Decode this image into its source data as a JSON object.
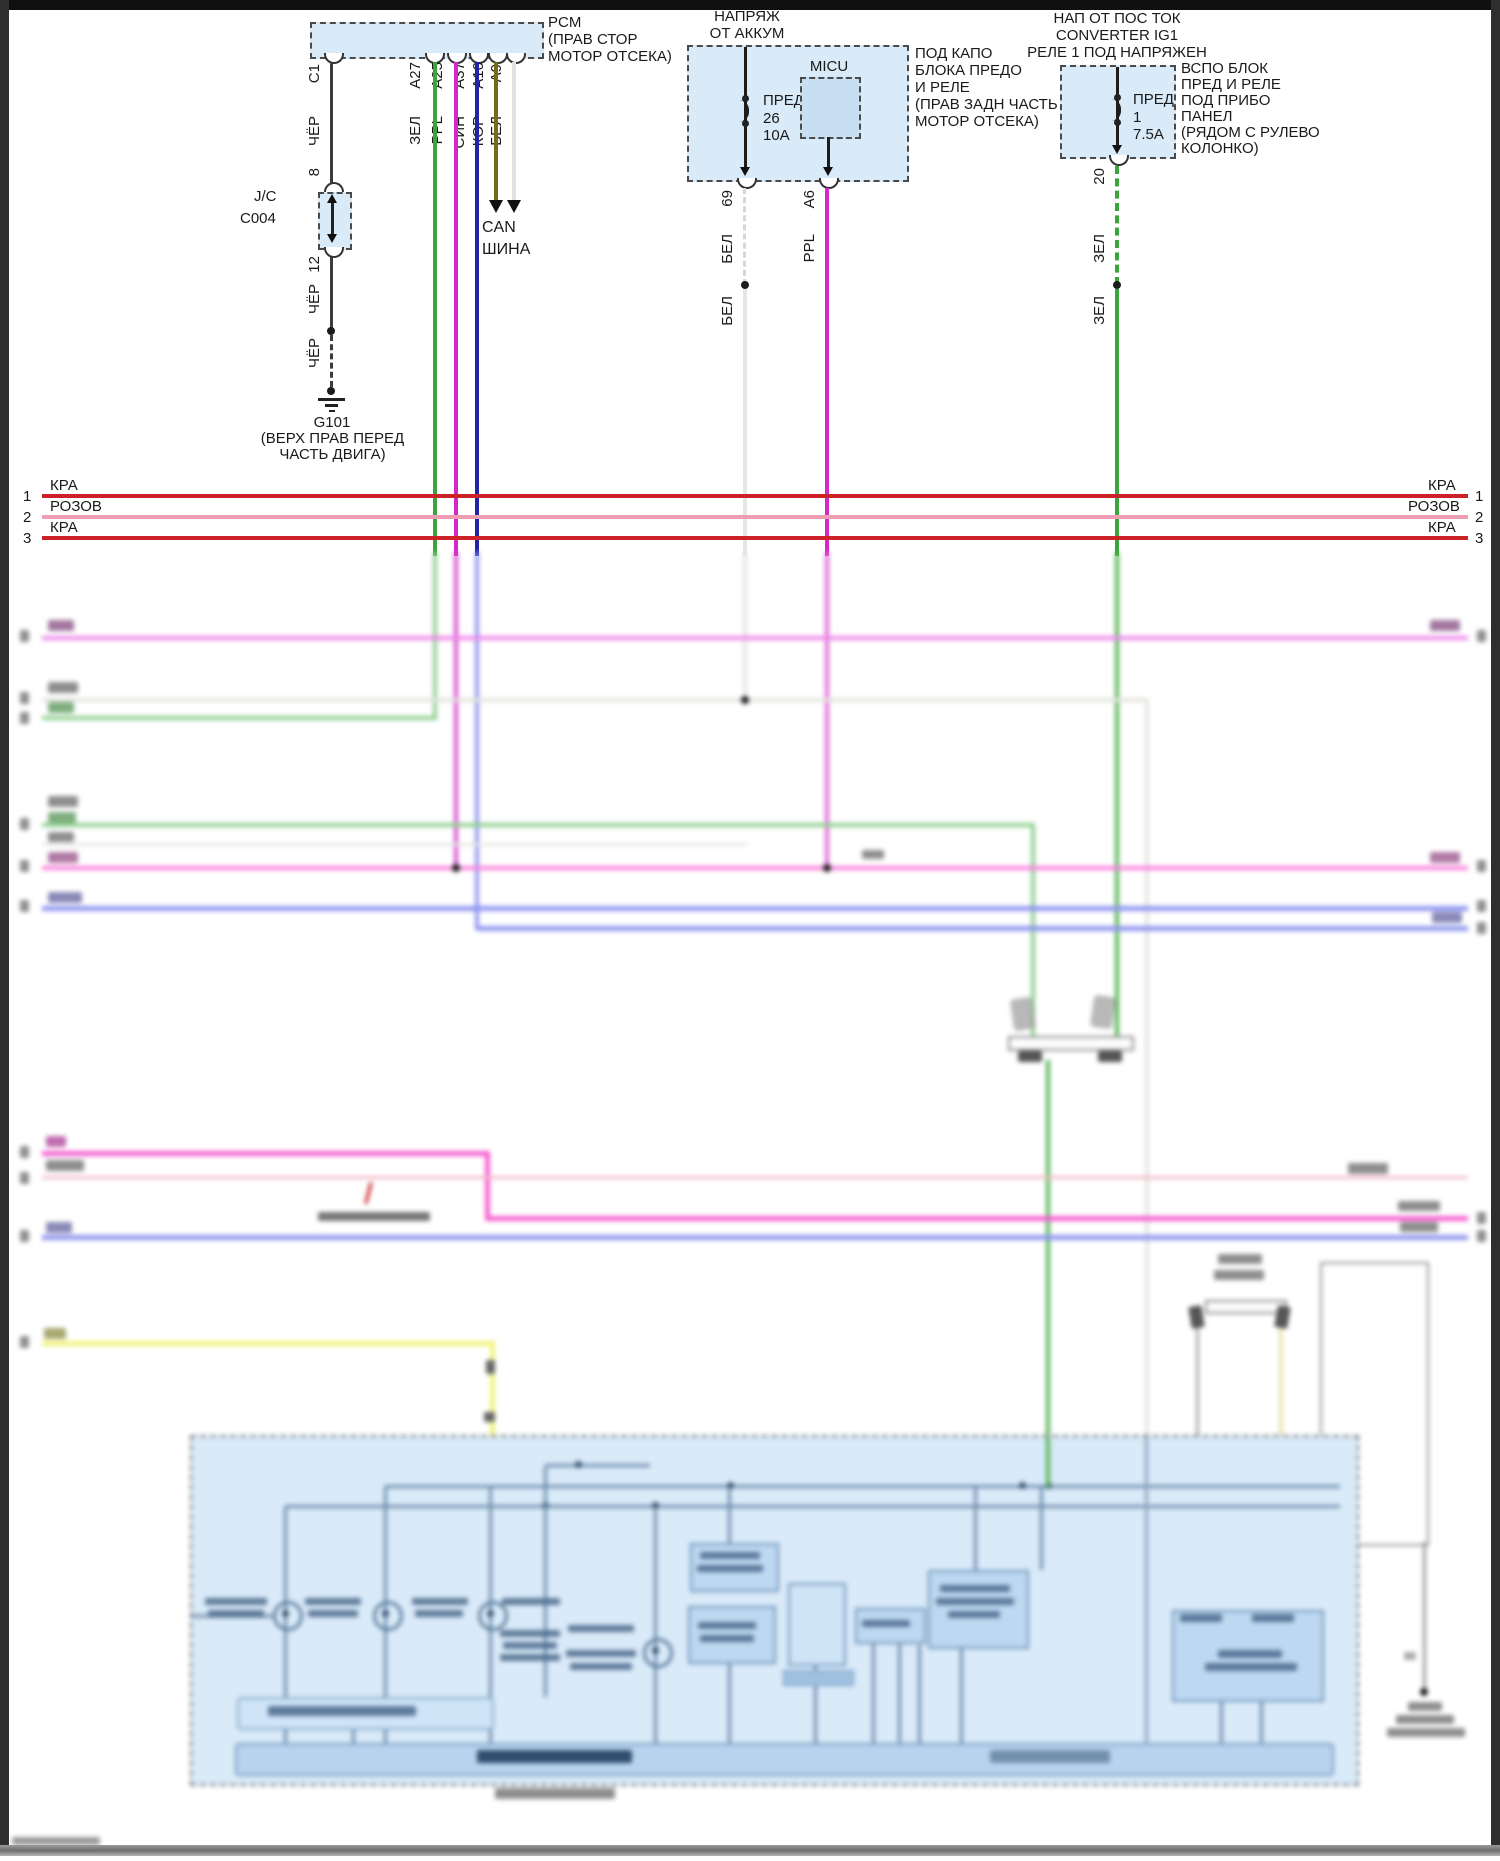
{
  "diagram": {
    "pcm": {
      "name": "PCM",
      "location_line1": "(ПРАВ СТОР",
      "location_line2": "МОТОР ОТСЕКА)",
      "pins": [
        "C1",
        "A27",
        "A25",
        "A37",
        "A10",
        "A9"
      ],
      "wire_colors": [
        "ЧЁР",
        "ЗЕЛ",
        "PPL",
        "СИН",
        "КОР",
        "БЕЛ"
      ]
    },
    "junction": {
      "type": "J/C",
      "id": "C004",
      "pin_in": "8",
      "pin_out": "12",
      "wire_color_above": "ЧЁР",
      "wire_color_below": "ЧЁР"
    },
    "ground_g101": {
      "id": "G101",
      "location_line1": "(ВЕРХ ПРАВ ПЕРЕД",
      "location_line2": "ЧАСТЬ ДВИГА)"
    },
    "can_bus": {
      "line1": "CAN",
      "line2": "ШИНА"
    },
    "battery_box": {
      "source_line1": "НАПРЯЖ",
      "source_line2": "ОТ АККУМ",
      "fuse_label": "ПРЕД",
      "fuse_number": "26",
      "fuse_rating": "10A",
      "module": "MICU",
      "location": [
        "ПОД КАПО",
        "БЛОКА ПРЕДО",
        "И РЕЛЕ",
        "(ПРАВ ЗАДН ЧАСТЬ",
        "МОТОР ОТСЕКА)"
      ],
      "pin_fuse": "69",
      "fuse_wire_color": "БЕЛ",
      "fuse_wire_color2": "БЕЛ",
      "pin_micu": "A6",
      "micu_wire_color": "PPL"
    },
    "ig1_box": {
      "source_line1": "НАП ОТ ПОС ТОК",
      "source_line2": "CONVERTER IG1",
      "source_line3": "РЕЛЕ 1 ПОД НАПРЯЖЕН",
      "fuse_label": "ПРЕД",
      "fuse_number": "1",
      "fuse_rating": "7.5A",
      "location": [
        "ВСПО БЛОК",
        "ПРЕД И РЕЛЕ",
        "ПОД ПРИБО",
        "ПАНЕЛ",
        "(РЯДОМ С РУЛЕВО",
        "КОЛОНКО)"
      ],
      "pin": "20",
      "wire_color": "ЗЕЛ",
      "wire_color2": "ЗЕЛ"
    },
    "bus_rows": [
      {
        "num": "1",
        "label": "КРА",
        "color": "#cc2127"
      },
      {
        "num": "2",
        "label": "РОЗОВ",
        "color": "#ef9db2"
      },
      {
        "num": "3",
        "label": "КРА",
        "color": "#cc2127"
      }
    ],
    "wire_palette": {
      "black": "#3c3c3c",
      "green": "#3aa53a",
      "magenta": "#d428c8",
      "blue": "#2323aa",
      "brown": "#7a6a10",
      "white": "#e6e6e2",
      "red": "#cc2127",
      "pink_row": "#ef9db2",
      "violet": "#ee86ea",
      "bright_pink": "#f560cf",
      "pale_pink": "#f2bac8",
      "periwinkle": "#8f96ef",
      "light_green": "#90cf90",
      "dark_green": "#57b357",
      "yellow": "#f3f37e",
      "box_fill": "#d9eaf8"
    }
  }
}
